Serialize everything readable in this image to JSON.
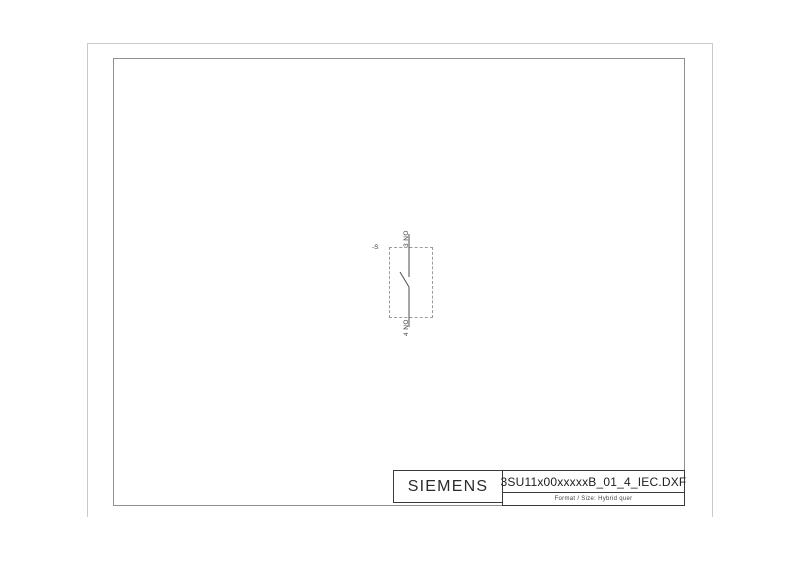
{
  "drawing": {
    "symbol": {
      "device_tag": "-S",
      "top_terminal_label": "3 NO",
      "bottom_terminal_label": "4 NO"
    },
    "title_block": {
      "brand": "SIEMENS",
      "filename": "3SU11x00xxxxxB_01_4_IEC.DXF",
      "format_label": "Format / Size: Hybrid quer"
    },
    "colors": {
      "outer_border": "#c9c9c9",
      "inner_frame": "#8f8f8f",
      "title_block_border": "#3a3a3a",
      "symbol_line": "#4d4d4d",
      "dashed_box": "#9b9b9b",
      "text": "#3c3c3c"
    }
  }
}
